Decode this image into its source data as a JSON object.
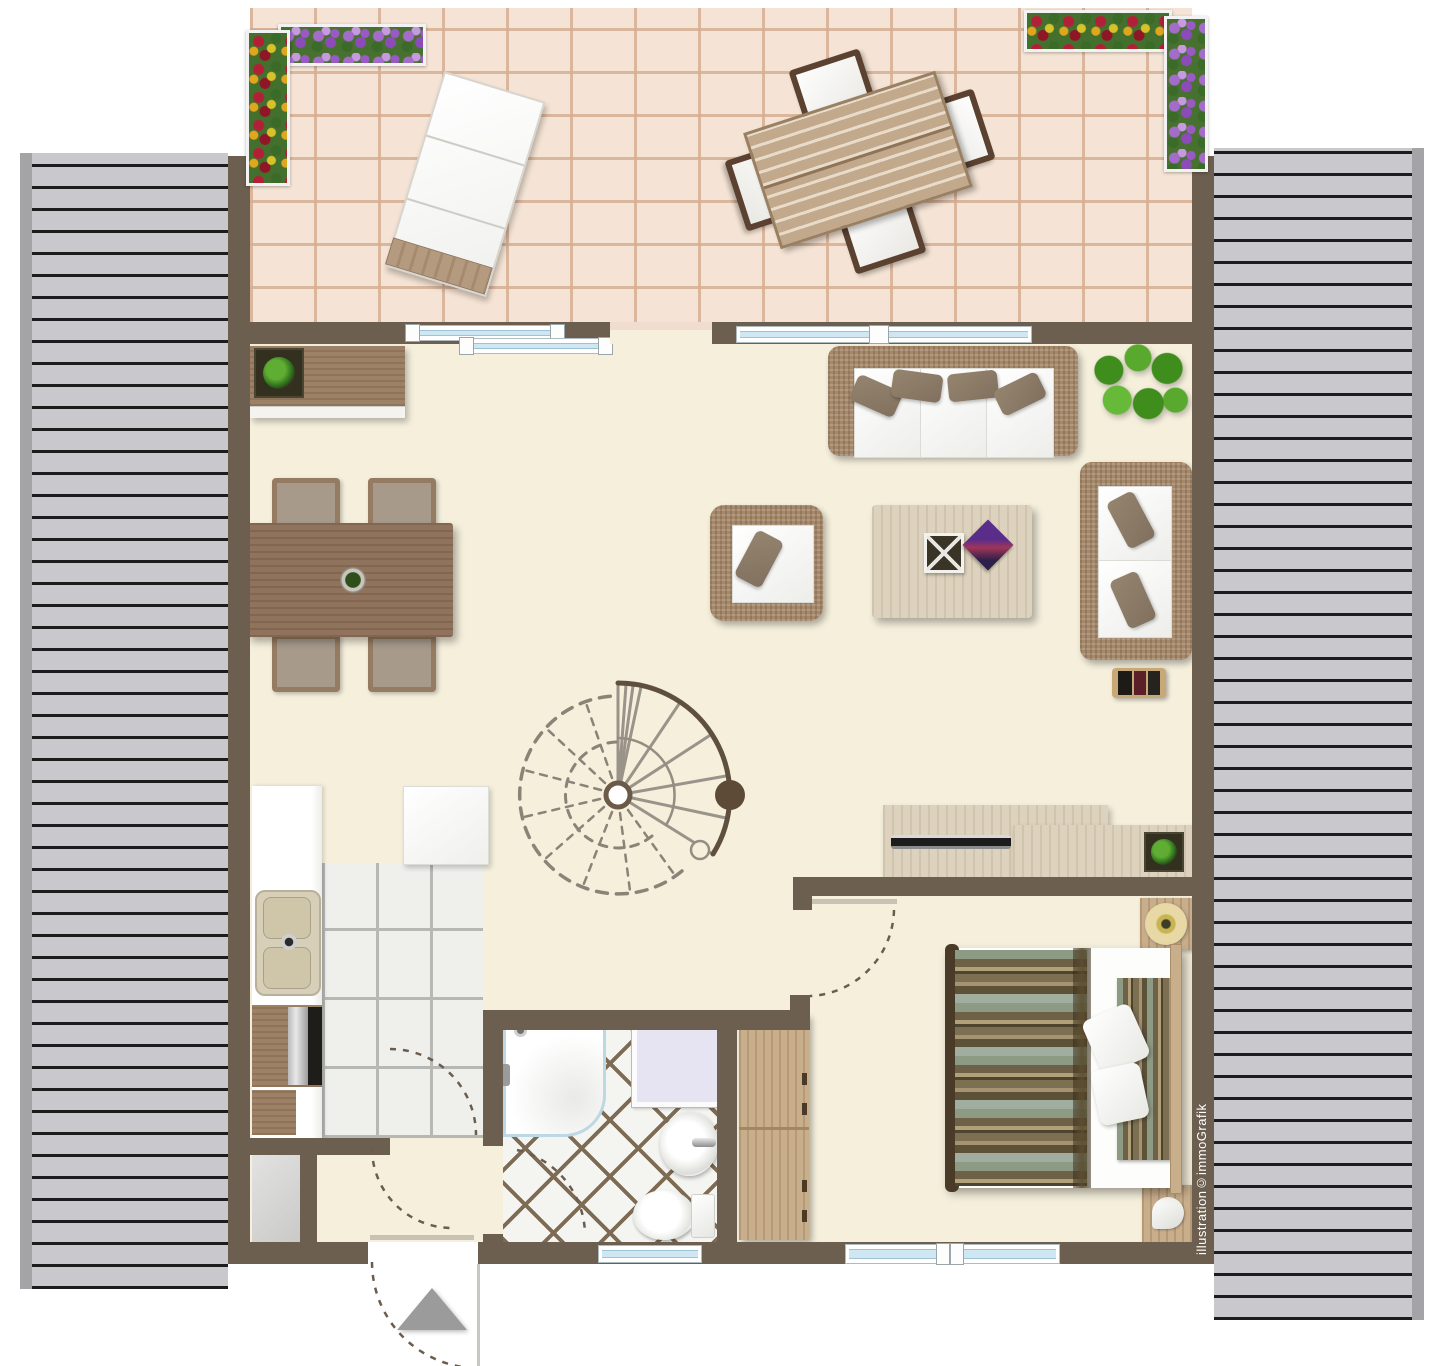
{
  "watermark": {
    "text": "illustration©immoGrafik"
  },
  "palette": {
    "wall": "#6c5f4f",
    "roof_plank": "#c9c9cd",
    "roof_line": "#1c1c1c",
    "terrace_brick": "#f5e4d5",
    "terrace_grout": "#d5ae92",
    "interior_floor": "#f5efdc",
    "kitchen_tile": "#efefec",
    "bath_grout": "#7e6b54",
    "glass": "#cfe7f3",
    "wicker": "#a5886a",
    "wood_mid": "#8f735c",
    "wood_light": "#ddd2bd",
    "wood_tan": "#c9ae8c",
    "bed_sage": "#9fae9e",
    "bed_brown": "#6e6148",
    "plant_green": "#3f8d1d",
    "flower_purple": "#a46cc9",
    "flower_red": "#b41f38",
    "arrow_gray": "#9b9b9b"
  },
  "floor_plan": {
    "type": "attic-apartment-top-view",
    "rooms": [
      {
        "name": "terrace",
        "features": [
          "brick-paving",
          "flower-box-left",
          "flower-box-right",
          "sun-lounger",
          "outdoor-dining-table",
          "four-outdoor-chairs"
        ]
      },
      {
        "name": "living-dining-room",
        "features": [
          "sideboard-with-planter",
          "dining-table",
          "four-dining-chairs",
          "wicker-sofa-3-seat",
          "wicker-sofa-2-seat",
          "wicker-armchair",
          "coffee-table-with-bowl-and-magazine",
          "large-plant",
          "small-bench",
          "spiral-staircase",
          "tv-lowboard",
          "lowboard-with-planter"
        ]
      },
      {
        "name": "kitchen",
        "features": [
          "counter",
          "double-sink",
          "stove",
          "cabinet",
          "tiled-floor",
          "door-swing"
        ]
      },
      {
        "name": "hallway",
        "features": [
          "entrance-door",
          "entrance-arrow",
          "storage-closet"
        ]
      },
      {
        "name": "bathroom",
        "features": [
          "shower",
          "washer",
          "round-washbasin",
          "toilet",
          "diagonal-tiled-floor",
          "door-swing",
          "window"
        ]
      },
      {
        "name": "bedroom",
        "features": [
          "double-bed",
          "two-pillows",
          "nightstand-with-lamp",
          "nightstand-with-phone",
          "wardrobe",
          "door-swing",
          "window"
        ]
      }
    ],
    "roof_areas": [
      "left-roof-slope",
      "right-roof-slope"
    ],
    "glazing": [
      "terrace-sliding-door",
      "terrace-window-band",
      "bathroom-window",
      "bedroom-window"
    ]
  }
}
